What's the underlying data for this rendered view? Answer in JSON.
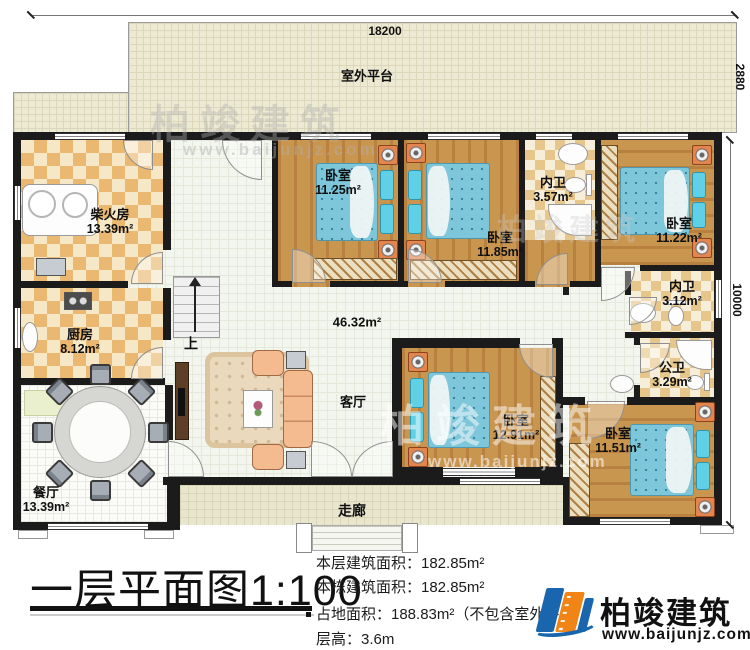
{
  "dims": {
    "top": "18200",
    "platform_depth": "2880",
    "side": "10000"
  },
  "platform": {
    "label": "室外平台"
  },
  "rooms": {
    "firewood": {
      "name": "柴火房",
      "area": "13.39m²"
    },
    "kitchen": {
      "name": "厨房",
      "area": "8.12m²"
    },
    "dining": {
      "name": "餐厅",
      "area": "13.39m²"
    },
    "living": {
      "name": "客厅",
      "hall_area": "46.32m²"
    },
    "bedroom1": {
      "name": "卧室",
      "area": "11.25m²"
    },
    "bedroom2": {
      "name": "卧室",
      "area": "11.85m²"
    },
    "bath1": {
      "name": "内卫",
      "area": "3.57m²"
    },
    "bedroom3": {
      "name": "卧室",
      "area": "11.22m²"
    },
    "bath2": {
      "name": "内卫",
      "area": "3.12m²"
    },
    "bath3": {
      "name": "公卫",
      "area": "3.29m²"
    },
    "bedroom4": {
      "name": "卧室",
      "area": "12.91m²"
    },
    "bedroom5": {
      "name": "卧室",
      "area": "11.51m²"
    },
    "corridor": {
      "name": "走廊"
    },
    "stairs": {
      "up": "上"
    }
  },
  "footer": {
    "title": "一层平面图1:100",
    "info": [
      "本层建筑面积：182.85m²",
      "本栋建筑面积：182.85m²",
      "占地面积：188.83m²（不包含室外平台）",
      "层高：3.6m"
    ]
  },
  "brand": {
    "name": "柏竣建筑",
    "site": "www.baijunjz.com"
  },
  "watermark": {
    "name": "柏竣建筑",
    "site": "www.baijunjz.com"
  },
  "colors": {
    "wall": "#1b1b1b",
    "bed_blue": "#7ec6da",
    "accent_blue": "#1a66ae",
    "accent_orange": "#f08416"
  }
}
